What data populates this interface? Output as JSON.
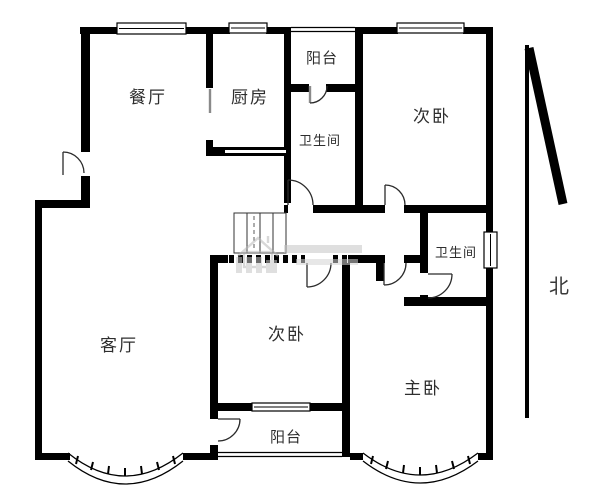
{
  "title": "apartment-floor-plan",
  "labels": {
    "dining": "餐厅",
    "kitchen": "厨房",
    "balcony_top": "阳台",
    "bathroom_top": "卫生间",
    "bedroom_top": "次卧",
    "bathroom_right": "卫生间",
    "north": "北",
    "living": "客厅",
    "bedroom_mid": "次卧",
    "master": "主卧",
    "balcony_bottom": "阳台"
  },
  "colors": {
    "wall": "#000000",
    "label": "#2e2e2e",
    "north": "#3a3a3a",
    "door": "#2b2b2b",
    "thin": "#444444",
    "watermark": "#c8c8c8",
    "background": "#ffffff"
  }
}
